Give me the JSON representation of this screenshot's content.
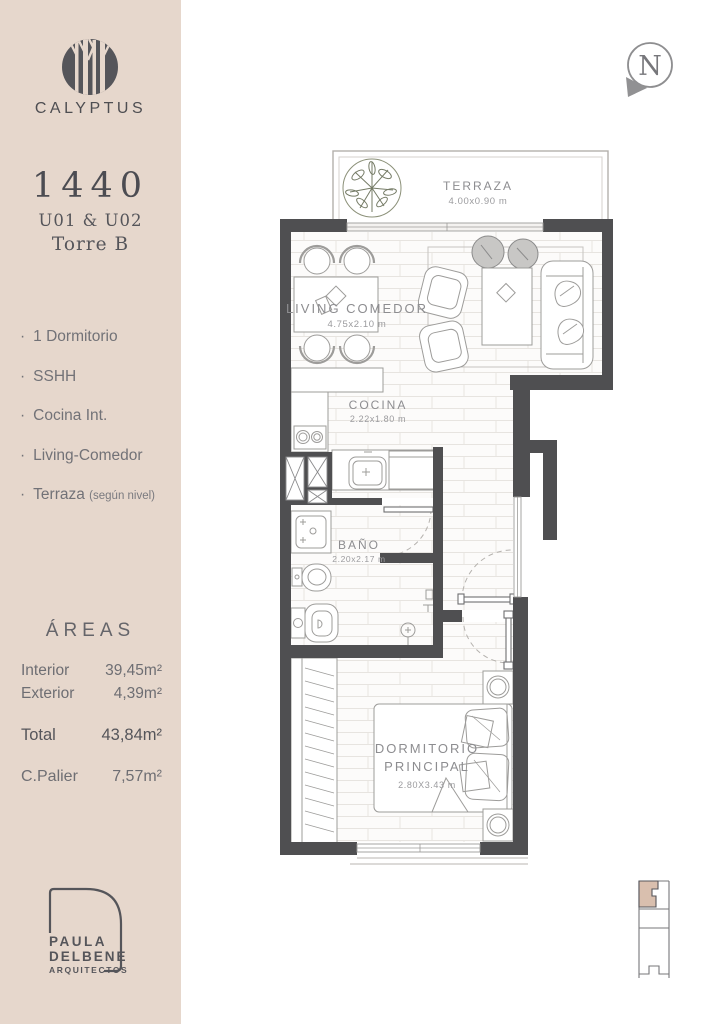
{
  "sidebar": {
    "bg": "#e6d7cc",
    "brand": "CALYPTUS",
    "unit_number": "1440",
    "unit_codes": "U01 & U02",
    "tower": "Torre B",
    "bullet": "·",
    "features": [
      {
        "label": "1 Dormitorio",
        "note": ""
      },
      {
        "label": "SSHH",
        "note": ""
      },
      {
        "label": "Cocina Int.",
        "note": ""
      },
      {
        "label": "Living-Comedor",
        "note": ""
      },
      {
        "label": "Terraza",
        "note": "(según nivel)"
      }
    ],
    "areas": {
      "title": "ÁREAS",
      "rows": [
        {
          "label": "Interior",
          "value": "39,45m²"
        },
        {
          "label": "Exterior",
          "value": "4,39m²"
        },
        {
          "label": "Total",
          "value": "43,84m²"
        },
        {
          "label": "C.Palier",
          "value": "7,57m²"
        }
      ]
    },
    "architect": {
      "line1": "PAULA",
      "line2": "DELBENE",
      "line3": "ARQUITECTOS"
    }
  },
  "plan": {
    "north_label": "N",
    "rooms": {
      "terraza": {
        "name": "TERRAZA",
        "dims": "4.00x0.90 m"
      },
      "living": {
        "name": "LIVING COMEDOR",
        "dims": "4.75x2.10 m"
      },
      "cocina": {
        "name": "COCINA",
        "dims": "2.22x1.80 m"
      },
      "bano": {
        "name": "BAÑO",
        "dims": "2.20x2.17 m"
      },
      "dormitorio": {
        "name1": "DORMITORIO",
        "name2": "PRINCIPAL",
        "dims": "2.80X3.43 m"
      }
    },
    "colors": {
      "wall": "#4f4f51",
      "furniture_line": "#9d9c9a",
      "floor_line": "#e7e4e0",
      "unit_highlight": "#d9bfae",
      "label_text": "#8d8d90"
    }
  }
}
